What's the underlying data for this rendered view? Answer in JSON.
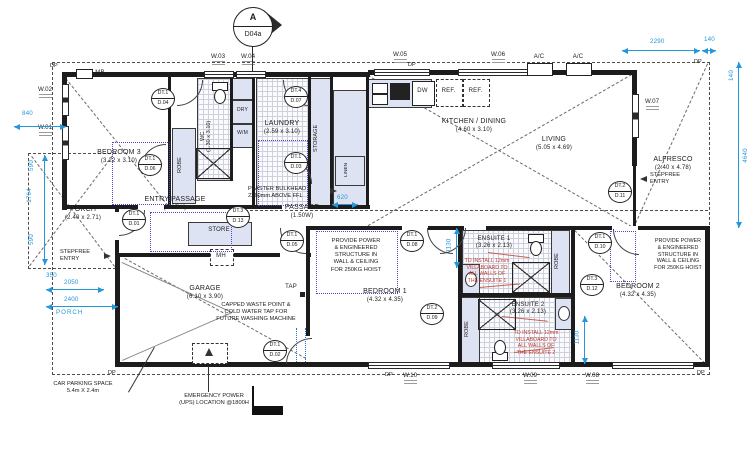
{
  "marker": {
    "letter": "A",
    "code": "D04a"
  },
  "rooms": {
    "bedroom3": {
      "name": "BEDROOM 3",
      "size": "(3.22 x 3.10)"
    },
    "wc": {
      "label": "WC\n(1.30 x 3.10)"
    },
    "laundry": {
      "name": "LAUNDRY",
      "size": "(2.59 x 3.10)"
    },
    "storage": {
      "name": "STORAGE"
    },
    "kitchen_dining": {
      "name": "KITCHEN / DINING",
      "size": "(4.60 x 3.10)"
    },
    "living": {
      "name": "LIVING",
      "size": "(5.05 x 4.69)"
    },
    "alfresco": {
      "name": "ALFRESCO",
      "size": "(2.40 x 4.78)"
    },
    "porch": {
      "name": "PORCH",
      "size": "(2.40 x 2.71)"
    },
    "entry_passage": {
      "name": "ENTRY PASSAGE",
      "size": "(1.95W)"
    },
    "passage": {
      "name": "PASSAGE",
      "size": "(1.50W)"
    },
    "store": {
      "name": "STORE"
    },
    "garage": {
      "name": "GARAGE",
      "size": "(6.10 x 3.90)"
    },
    "bedroom1": {
      "name": "BEDROOM 1",
      "size": "(4.32 x 4.35)"
    },
    "ensuite1": {
      "name": "ENSUITE 1",
      "size": "(3.26 x 2.13)"
    },
    "ensuite2": {
      "name": "ENSUITE 2",
      "size": "(3.26 x 2.13)"
    },
    "bedroom2": {
      "name": "BEDROOM 2",
      "size": "(4.32 x 4.35)"
    }
  },
  "fixtures": {
    "robe": "ROBE",
    "dry": "DRY",
    "wm": "W/M",
    "linen": "LINEN",
    "dw": "DW",
    "ref": "REF.",
    "mh": "MH",
    "mb": "MB",
    "ac": "A/C",
    "tap": "TAP",
    "dp": "DP"
  },
  "windows": {
    "w01": "W.01",
    "w02": "W.02",
    "w03": "W.03",
    "w04": "W.04",
    "w05": "W.05",
    "w06": "W.06",
    "w07": "W.07",
    "w08": "W.08",
    "w09": "W.09",
    "w10": "W.10"
  },
  "doors": {
    "d01": {
      "tag": "DT.1",
      "no": "D.01"
    },
    "d02": {
      "tag": "DT.1",
      "no": "D.02"
    },
    "d03": {
      "tag": "DT.1",
      "no": "D.03"
    },
    "d04": {
      "tag": "DT.1",
      "no": "D.04"
    },
    "d05": {
      "tag": "DT.1",
      "no": "D.05"
    },
    "d06": {
      "tag": "DT.1",
      "no": "D.06"
    },
    "d07": {
      "tag": "DT.4",
      "no": "D.07"
    },
    "d08": {
      "tag": "DT.1",
      "no": "D.08"
    },
    "d09": {
      "tag": "DT.2",
      "no": "D.09"
    },
    "d10": {
      "tag": "DT.1",
      "no": "D.10"
    },
    "d11": {
      "tag": "DT.2",
      "no": "D.11"
    },
    "d12": {
      "tag": "DT.3",
      "no": "D.12"
    },
    "d13": {
      "tag": "DT.3",
      "no": "D.13"
    }
  },
  "dims": {
    "left_840": "840",
    "left_590a": "590",
    "left_1764": "1764",
    "left_590b": "590",
    "left_350": "350",
    "left_2050": "2050",
    "left_2400": "2400",
    "left_porch": "PORCH",
    "top_2290": "2290",
    "top_140": "140",
    "right_140": "140",
    "right_4640": "4640",
    "mid_620": "620",
    "ens1_1130": "1130",
    "bed2_1130": "1130"
  },
  "notes": {
    "stepfree": "STEPFREE\nENTRY",
    "hoist": "PROVIDE POWER\n& ENGINEERED\nSTRUCTURE IN\nWALL & CEILING\nFOR 250KG HOIST",
    "villaboard1": "TO INSTALL 12mm\nVILLABOARD TO\nALL WALLS OF\nTHE  ENSUITE 1",
    "villaboard2": "TO INSTALL 12mm\nVILLABOARD TO\nALL WALLS OF\nTHE  ENSUITE 2",
    "bulkhead": "PLASTER BULKHEAD\n2260mm ABOVE FFL",
    "waste": "CAPPED WASTE POINT &\nCOLD WATER TAP FOR\nFUTURE WASHING MACHINE",
    "ups": "EMERGENCY POWER\n(UPS) LOCATION @1800H",
    "car_space": "CAR PARKING SPACE\n5.4m X 2.4m"
  }
}
